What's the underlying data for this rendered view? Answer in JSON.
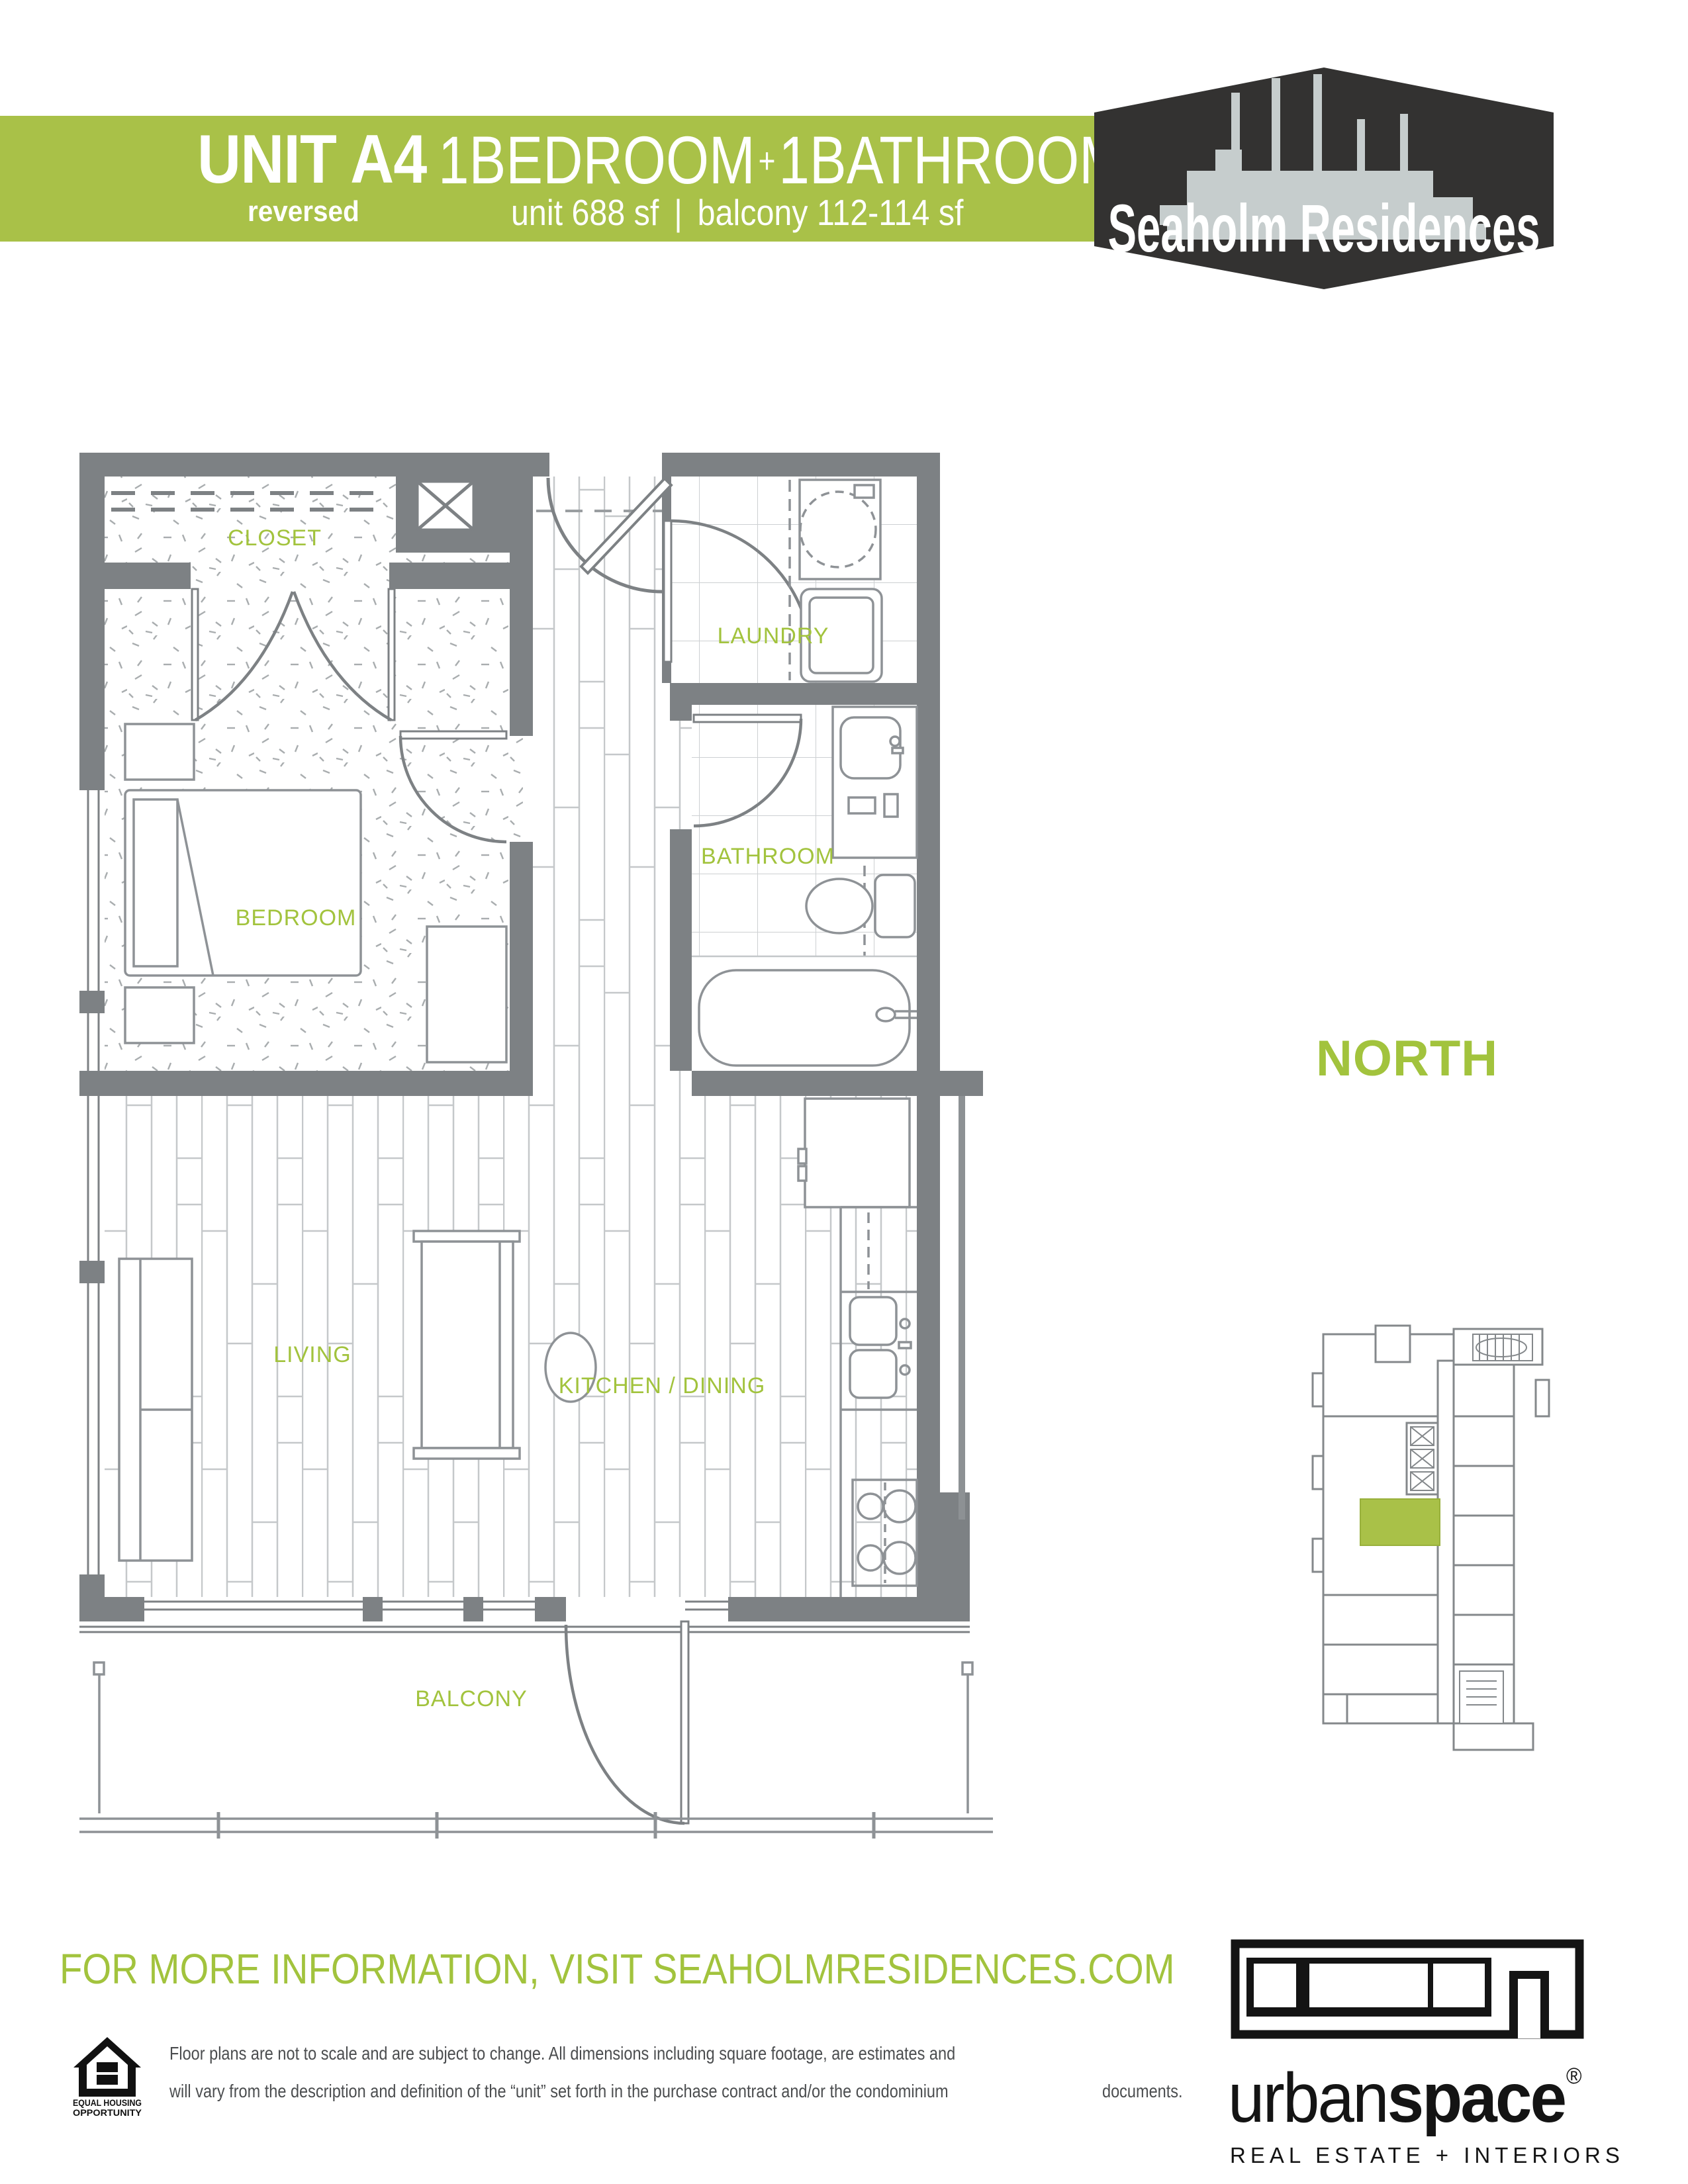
{
  "banner": {
    "green": "#a9c148",
    "unit_label": "UNIT A4",
    "variant": "reversed",
    "bedroom": "1BEDROOM",
    "plus": "+",
    "bathroom": "1BATHROOM",
    "unit_area": "unit 688 sf",
    "separator": "|",
    "balcony_area": "balcony 112-114 sf"
  },
  "badge": {
    "title": "Seaholm Residences",
    "bg": "#333231",
    "silhouette": "#c6cdcd"
  },
  "plan": {
    "wall_color": "#7d8184",
    "label_green": "#a2c33d",
    "labels": {
      "closet": "CLOSET",
      "laundry": "LAUNDRY",
      "bathroom": "BATHROOM",
      "bedroom": "BEDROOM",
      "living": "LIVING",
      "kitchen": "KITCHEN / DINING",
      "balcony": "BALCONY"
    }
  },
  "compass": {
    "label": "NORTH"
  },
  "keyplan": {
    "highlight": "#a9c148"
  },
  "info": {
    "line": "FOR MORE INFORMATION, VISIT SEAHOLMRESIDENCES.COM"
  },
  "disclaimer": {
    "lines": [
      "Floor plans are not to scale and are subject to change. All dimensions including square footage, are estimates and",
      "will vary from the description and definition of the “unit” set forth in the purchase contract and/or the condominium",
      "documents."
    ]
  },
  "eho": {
    "line1": "EQUAL HOUSING",
    "line2": "OPPORTUNITY"
  },
  "agency": {
    "brand_regular": "urban",
    "brand_bold": "space",
    "registered": "®",
    "tagline": "REAL ESTATE + INTERIORS"
  }
}
